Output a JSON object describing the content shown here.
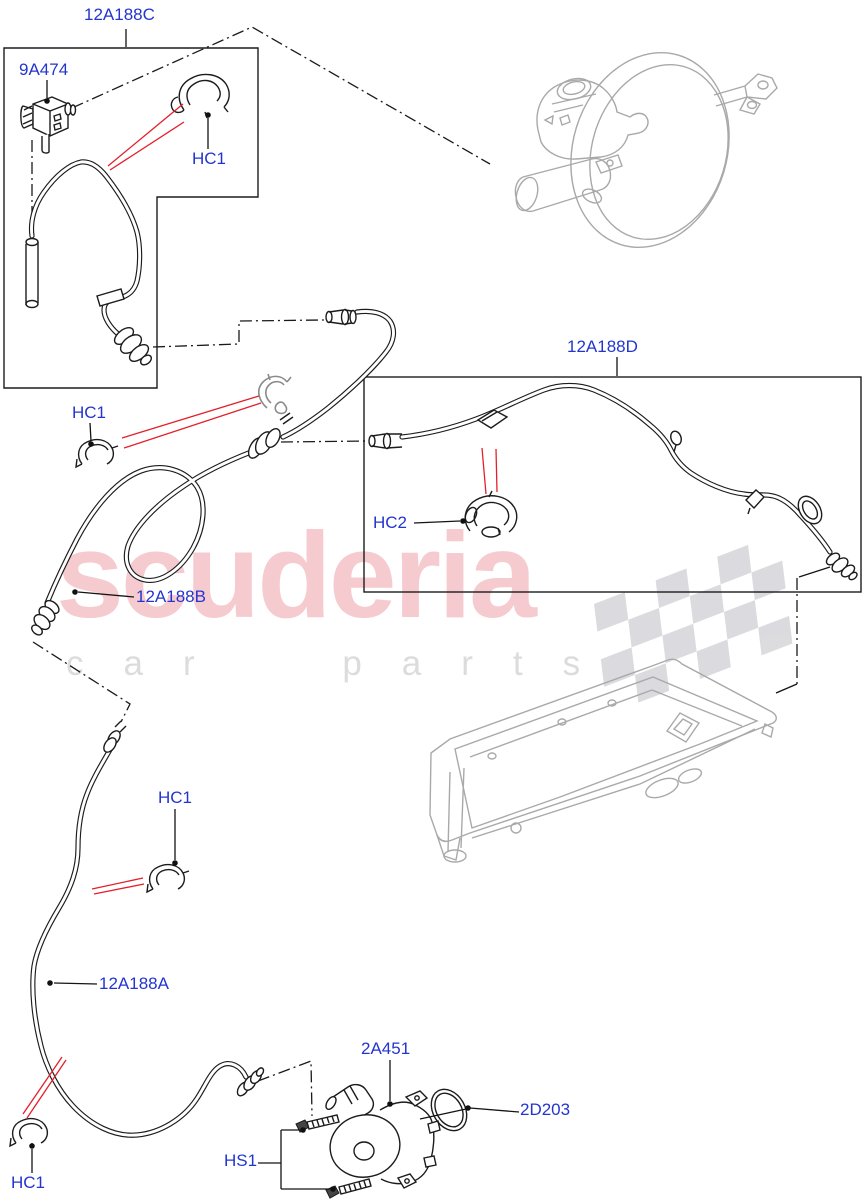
{
  "watermark": {
    "brand": "scuderia",
    "tagline": "car parts"
  },
  "labels": {
    "box_top": "12A188C",
    "valve": "9A474",
    "clip_top": "HC1",
    "clip_mid_left": "HC1",
    "clip_center": "HC1",
    "clip_bottom": "HC1",
    "clamp": "HC2",
    "hose_b": "12A188B",
    "hose_a": "12A188A",
    "box_right": "12A188D",
    "pump": "2A451",
    "seal": "2D203",
    "screws": "HS1"
  },
  "colors": {
    "label_blue": "#2335cf",
    "arrow_red": "#e3202a",
    "line_black": "#1a1a1a",
    "artwork_gray": "#a9a9a9",
    "watermark_pink": "#f6cbd0",
    "watermark_gray": "#dcdcdc"
  }
}
